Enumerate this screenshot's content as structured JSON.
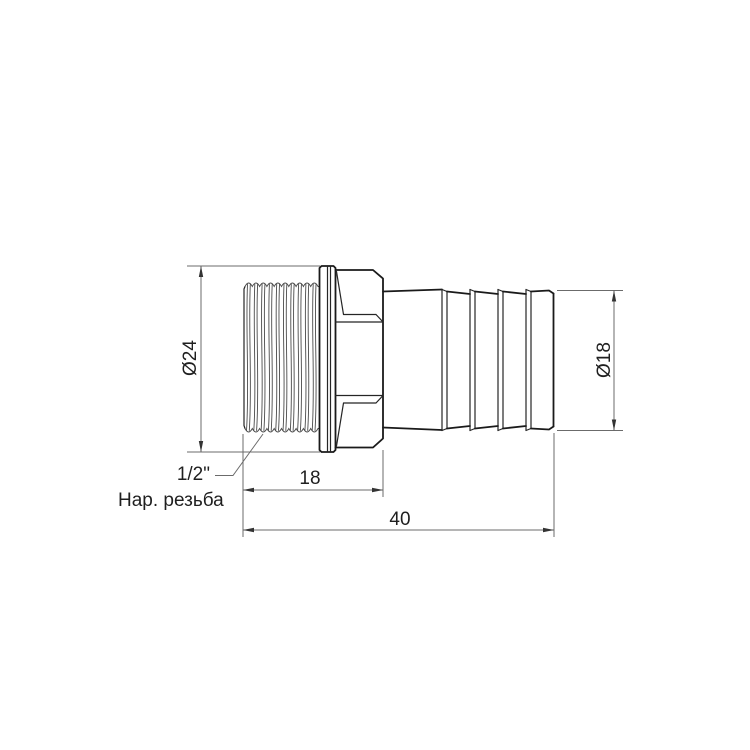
{
  "drawing": {
    "dimensions": {
      "thread_od": "Ø24",
      "barb_od": "Ø18",
      "thread_length": "18",
      "total_length": "40"
    },
    "labels": {
      "thread_size": "1/2\"",
      "thread_type": "Нар. резьба"
    },
    "colors": {
      "line": "#1a1a1a",
      "dimension_line": "#6b6b6b",
      "background": "#ffffff"
    }
  }
}
